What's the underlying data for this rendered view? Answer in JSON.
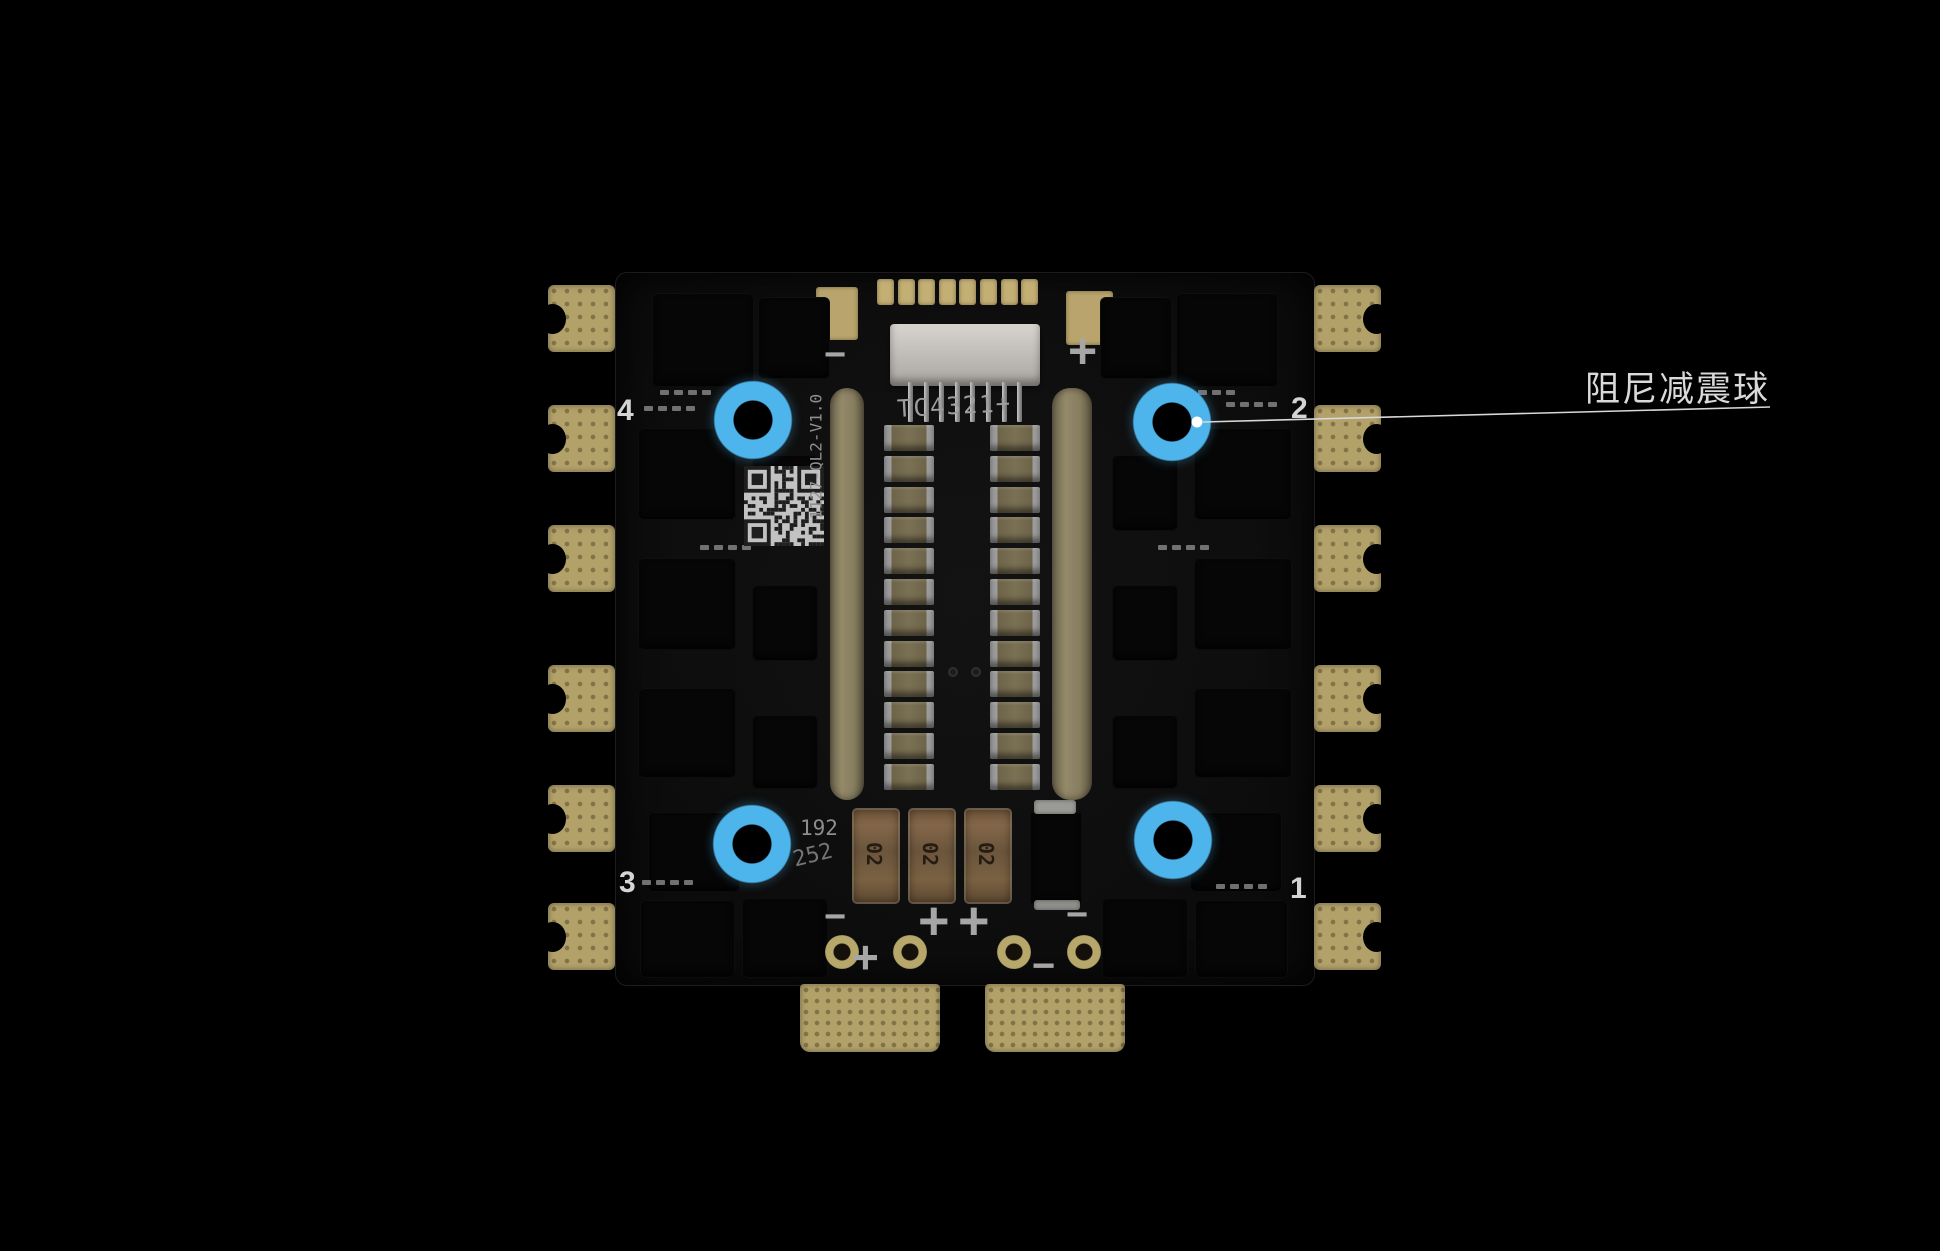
{
  "page": {
    "background_color": "#000000",
    "description": "4-in-1 ESC PCB product photo with damping-ball mounting holes highlighted"
  },
  "board": {
    "motor_numbers": {
      "top_left": "4",
      "top_right": "2",
      "bottom_left": "3",
      "bottom_right": "1"
    },
    "silkscreen": {
      "model": "TC4321+",
      "version": "1127-QL2-V1.0",
      "code_line1": "192",
      "code_line2": "252",
      "top_minus": "−",
      "top_plus": "+",
      "bottom_minus_left": "−",
      "bottom_plus_center_left": "+",
      "bottom_plus_center_right": "+",
      "bottom_minus_right": "−",
      "bottom_plus_pad": "+",
      "bottom_minus_pad": "−",
      "capacitor_marking": "02"
    },
    "colors": {
      "substrate": "#0e0e0e",
      "pad_gold": "#b2a169",
      "silkscreen": "#9e9e9e"
    }
  },
  "annotation": {
    "label": "阻尼减震球",
    "highlight_color": "#4db4ec",
    "line_color": "#d8d8d8",
    "highlight_count": 4
  }
}
